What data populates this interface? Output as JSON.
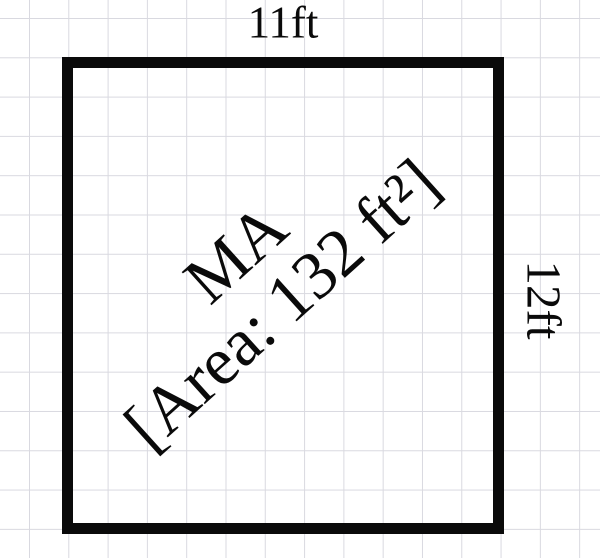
{
  "room": {
    "name": "MA",
    "area_label": "[Area: 132 ft²]",
    "top_dimension": "11ft",
    "right_dimension": "12ft"
  },
  "colors": {
    "wall": "#0a0a0a",
    "text": "#0a0a0a",
    "grid_line": "#d9d9e0",
    "background": "#ffffff"
  }
}
